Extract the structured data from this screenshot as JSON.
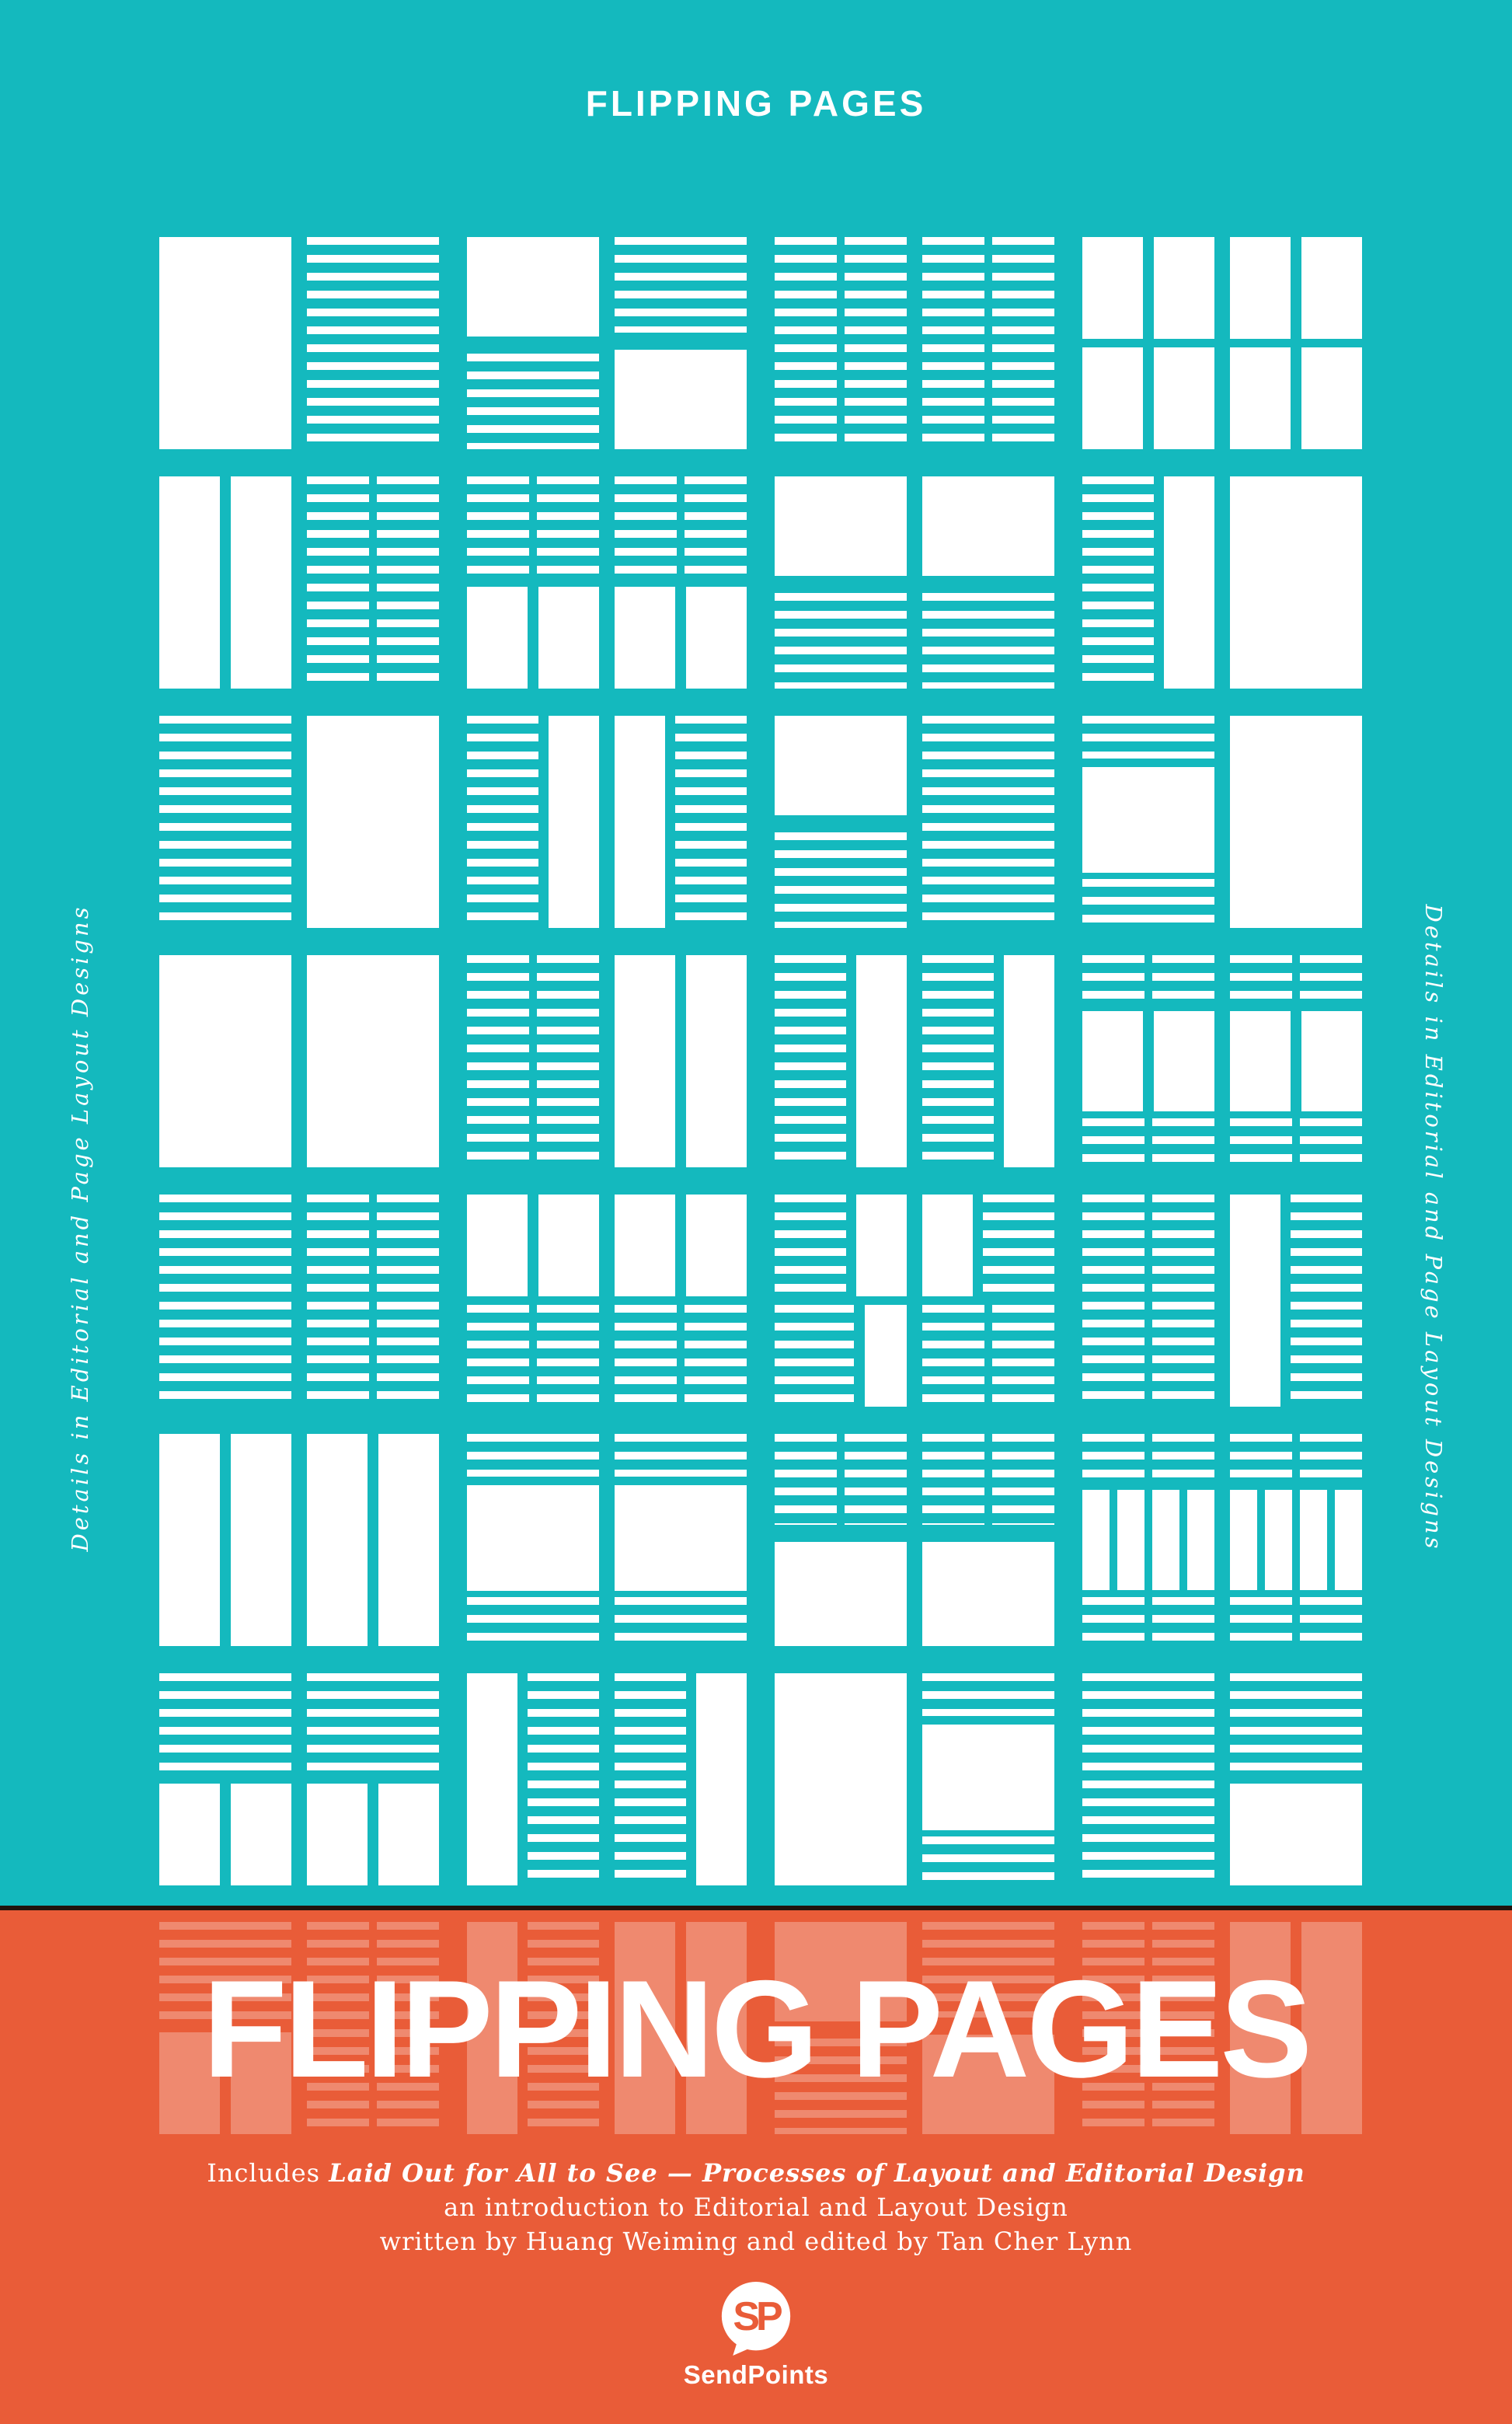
{
  "colors": {
    "teal": "#14b9be",
    "orange": "#e95c38",
    "divider": "#20130d",
    "thumbnail_ink": "#ffffff",
    "thumbnail_ink_faded": "rgba(255,255,255,0.28)"
  },
  "header": {
    "title": "FLIPPING PAGES"
  },
  "side_texts": {
    "left": "Details in Editorial and Page Layout Designs",
    "right": "Details in Editorial and Page Layout Designs"
  },
  "main_title": {
    "text": "FLIPPING PAGES"
  },
  "credits": {
    "includes_prefix": "Includes ",
    "book_emphasis": "Laid Out for All to See — Processes of Layout and Editorial Design",
    "line2": "an introduction to Editorial and Layout Design",
    "line3": "written by Huang Weiming and edited by Tan Cher Lynn"
  },
  "logo": {
    "monogram": "SP",
    "wordmark": "SendPoints"
  },
  "grid": {
    "teal_rows": [
      [
        "image",
        "lines",
        "image-lines",
        "lines-image",
        "dashes2",
        "dashes2",
        "split:bars2/bars2",
        "split:bars2/bars2"
      ],
      [
        "bars2",
        "dashes2",
        "split:dashes2/bars2",
        "split:dashes2/bars2",
        "image-lines",
        "image-lines",
        "dashes-bar",
        "image"
      ],
      [
        "lines",
        "image",
        "dashes-bar",
        "bar-dashes",
        "image-lines",
        "lines",
        "lines-image-lines",
        "image"
      ],
      [
        "image",
        "image",
        "dashes2",
        "bars2",
        "dashes-bar",
        "dashes-bar",
        "dashes-image-dashes",
        "dashes-image-dashes"
      ],
      [
        "lines",
        "dashes2",
        "split:bars2/dashes2",
        "split:bars2/dashes2",
        "split:dashes-bar/lines-bar",
        "split:bar-dashes/dashes2",
        "dashes2",
        "bar-dashes"
      ],
      [
        "bars2",
        "bars2",
        "lines-image-lines",
        "lines-image-lines",
        "dashes-image",
        "dashes-image",
        "dashes-bars4-dashes",
        "dashes-bars4-dashes"
      ],
      [
        "split:lines/bars2",
        "split:lines/bars2",
        "bar-dashes",
        "dashes-bar",
        "image",
        "lines-image-lines",
        "lines",
        "split:lines/image"
      ]
    ],
    "faded_rows": [
      [
        "split:lines/bars2",
        "dashes2",
        "bar-dashes",
        "bars2",
        "image-lines",
        "lines-image",
        "dashes2",
        "bars2"
      ]
    ]
  }
}
